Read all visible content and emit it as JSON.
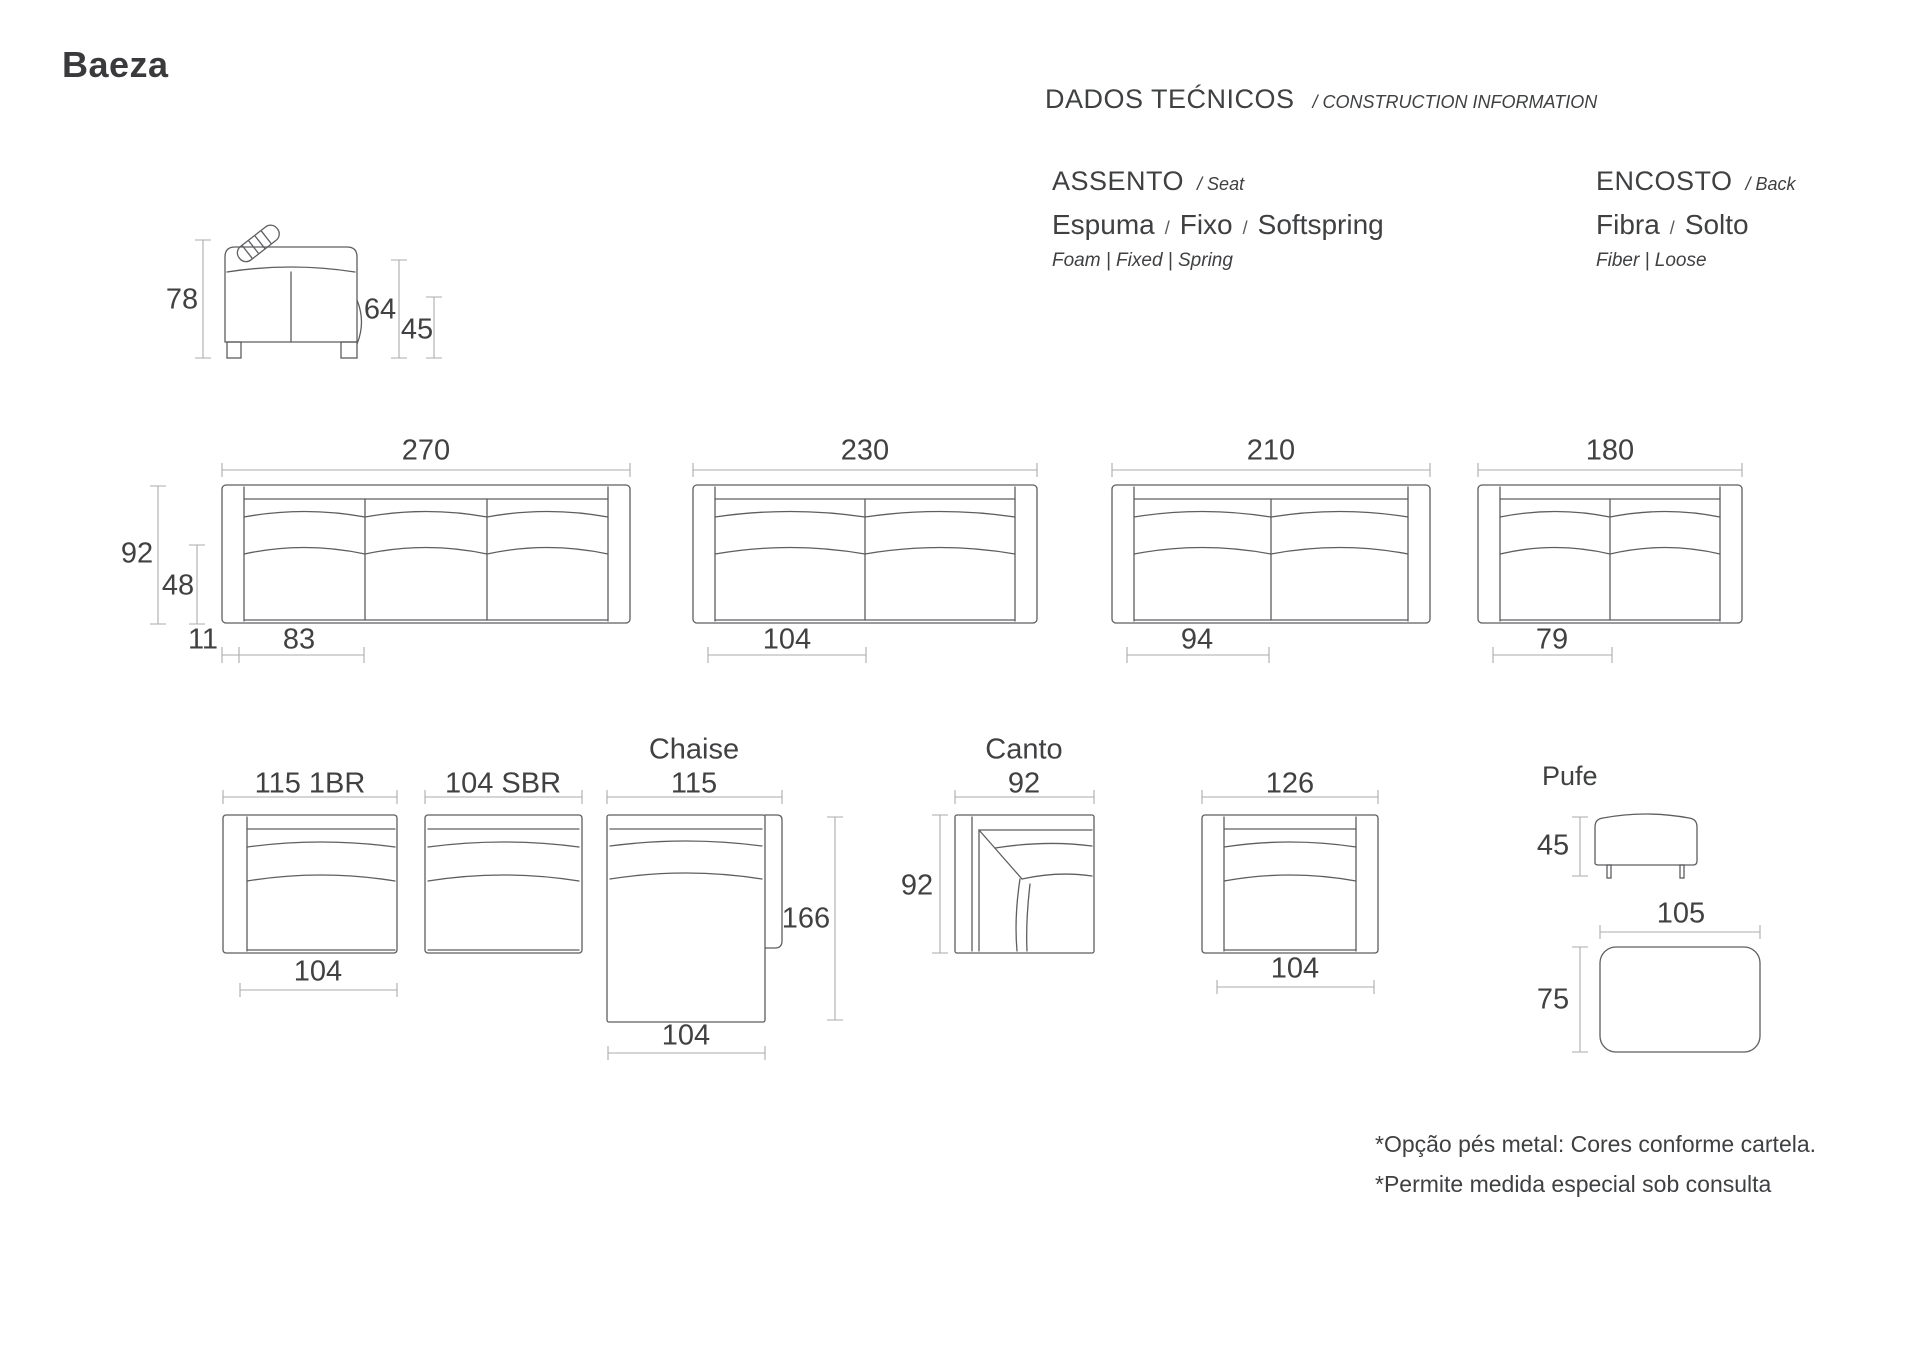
{
  "ui": {
    "slash": "/"
  },
  "title": "Baeza",
  "header": {
    "pt": "DADOS TEĆNICOS",
    "en": "/ CONSTRUCTION INFORMATION"
  },
  "specs": {
    "seat": {
      "label": "ASSENTO",
      "label_en": "/ Seat",
      "items": [
        "Espuma",
        "Fixo",
        "Softspring"
      ],
      "sub": "Foam | Fixed | Spring"
    },
    "back": {
      "label": "ENCOSTO",
      "label_en": "/ Back",
      "items": [
        "Fibra",
        "Solto"
      ],
      "sub": "Fiber | Loose"
    }
  },
  "side_view": {
    "total_height": "78",
    "arm_height": "64",
    "seat_height": "45"
  },
  "sofas": [
    {
      "width": "270",
      "height": "92",
      "seat_back_height": "48",
      "arm_width": "11",
      "seat_width": "83"
    },
    {
      "width": "230",
      "seat_width": "104"
    },
    {
      "width": "210",
      "seat_width": "94"
    },
    {
      "width": "180",
      "seat_width": "79"
    }
  ],
  "modules": {
    "one_arm": {
      "label": "115 1BR",
      "seat_width": "104"
    },
    "no_arm": {
      "label": "104 SBR"
    },
    "chaise": {
      "label": "Chaise",
      "width": "115",
      "depth": "166",
      "seat_width": "104"
    },
    "canto": {
      "label": "Canto",
      "width": "92",
      "depth": "92"
    },
    "armchair": {
      "width": "126",
      "seat_width": "104"
    },
    "pufe": {
      "label": "Pufe",
      "height": "45",
      "width": "105",
      "depth": "75"
    }
  },
  "footnotes": [
    "*Opção pés metal: Cores conforme cartela.",
    "*Permite medida especial sob consulta"
  ]
}
